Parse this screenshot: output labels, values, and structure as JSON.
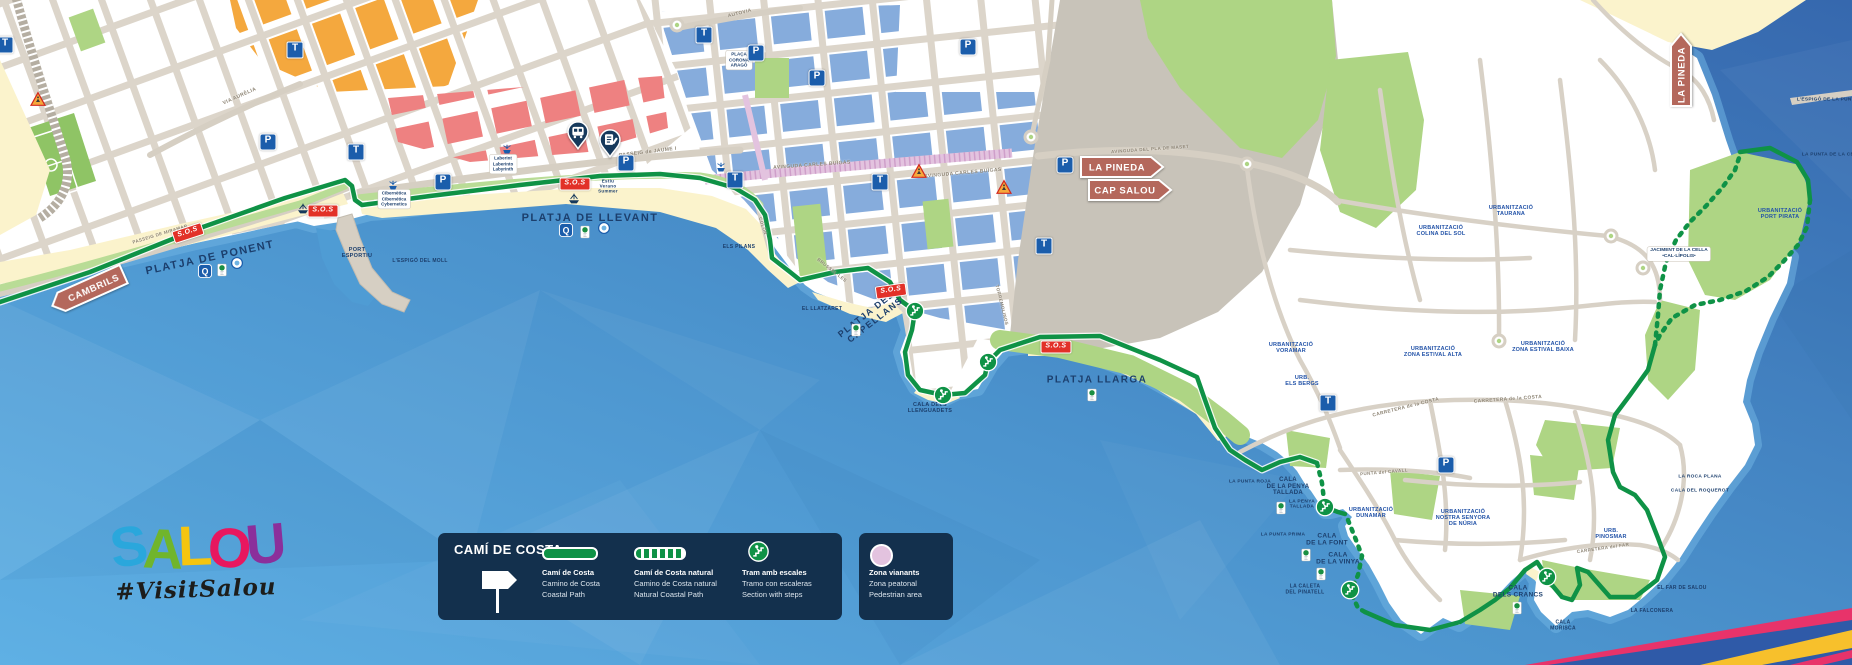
{
  "logo": {
    "letters": [
      {
        "ch": "S",
        "color": "#2aa7dc"
      },
      {
        "ch": "A",
        "color": "#70b52c"
      },
      {
        "ch": "L",
        "color": "#f5c50f"
      },
      {
        "ch": "O",
        "color": "#e8175f"
      },
      {
        "ch": "U",
        "color": "#8b2f9b"
      }
    ],
    "hashtag": "#VisitSalou"
  },
  "legend": {
    "title": "CAMÍ DE COSTA",
    "items": [
      {
        "key": "solid",
        "lines": [
          "Camí de Costa",
          "Camino de Costa",
          "Coastal Path"
        ]
      },
      {
        "key": "dashed",
        "lines": [
          "Camí de Costa natural",
          "Camino de Costa natural",
          "Natural Coastal Path"
        ]
      },
      {
        "key": "stairs",
        "lines": [
          "Tram amb escales",
          "Tramo con escaleras",
          "Section with steps"
        ]
      }
    ],
    "pedestrian": {
      "lines": [
        "Zona vianants",
        "Zona peatonal",
        "Pedestrian area"
      ]
    }
  },
  "signs": [
    {
      "label": "CAMBRILS",
      "dir": "left",
      "x": 88,
      "y": 290,
      "w": 78,
      "rot": -24
    },
    {
      "label": "LA PINEDA",
      "dir": "right",
      "x": 1122,
      "y": 167,
      "w": 82,
      "rot": 0
    },
    {
      "label": "CAP SALOU",
      "dir": "right",
      "x": 1130,
      "y": 190,
      "w": 82,
      "rot": 0
    },
    {
      "label": "LA PINEDA",
      "dir": "up",
      "x": 1681,
      "y": 70,
      "w": 72,
      "rot": 0
    }
  ],
  "map": {
    "icon_glyphs": {
      "parking": "P",
      "tram": "T",
      "sos": "S.O.S"
    },
    "labels": [
      {
        "t": "PLATJA DE PONENT",
        "x": 210,
        "y": 258,
        "r": -12,
        "s": 11,
        "c": "beach"
      },
      {
        "t": "PLATJA DE LLEVANT",
        "x": 590,
        "y": 218,
        "r": 0,
        "s": 11,
        "c": "beach"
      },
      {
        "t": "PLATJA DELS\nCAPELLANS",
        "x": 872,
        "y": 316,
        "r": -38,
        "s": 9,
        "c": "beach"
      },
      {
        "t": "PLATJA LLARGA",
        "x": 1097,
        "y": 380,
        "r": 0,
        "s": 10,
        "c": "beach"
      },
      {
        "t": "PORT\nESPORTIU",
        "x": 357,
        "y": 253,
        "r": 0,
        "s": 5.5,
        "c": "place"
      },
      {
        "t": "L'ESPIGÓ DEL MOLL",
        "x": 420,
        "y": 262,
        "r": 0,
        "s": 5,
        "c": "place"
      },
      {
        "t": "ELS PILANS",
        "x": 739,
        "y": 248,
        "r": 0,
        "s": 5,
        "c": "place"
      },
      {
        "t": "EL LLATZARET",
        "x": 822,
        "y": 310,
        "r": 0,
        "s": 5,
        "c": "place"
      },
      {
        "t": "CALA DELS\nLLENGUADETS",
        "x": 930,
        "y": 408,
        "r": 0,
        "s": 5.5,
        "c": "place"
      },
      {
        "t": "CALA\nDE LA PENYA\nTALLADA",
        "x": 1288,
        "y": 487,
        "r": 0,
        "s": 6,
        "c": "place"
      },
      {
        "t": "LA PENYA\nTALLADA",
        "x": 1302,
        "y": 505,
        "r": 0,
        "s": 4.8,
        "c": "place"
      },
      {
        "t": "LA PUNTA PRIMA",
        "x": 1283,
        "y": 535,
        "r": 0,
        "s": 4.8,
        "c": "place"
      },
      {
        "t": "LA PUNTA ROJA",
        "x": 1250,
        "y": 482,
        "r": 0,
        "s": 4.8,
        "c": "place"
      },
      {
        "t": "CALA\nDE LA FONT",
        "x": 1327,
        "y": 540,
        "r": 0,
        "s": 6.5,
        "c": "place"
      },
      {
        "t": "CALA\nDE LA VINYA",
        "x": 1338,
        "y": 559,
        "r": 0,
        "s": 6.5,
        "c": "place"
      },
      {
        "t": "LA CALETA\nDEL PINATELL",
        "x": 1305,
        "y": 590,
        "r": 0,
        "s": 5,
        "c": "place"
      },
      {
        "t": "CALA\nDELS CRANCS",
        "x": 1518,
        "y": 592,
        "r": 0,
        "s": 6.5,
        "c": "place"
      },
      {
        "t": "CALA\nMORISCA",
        "x": 1563,
        "y": 626,
        "r": 0,
        "s": 5,
        "c": "place"
      },
      {
        "t": "EL FAR DE SALOU",
        "x": 1682,
        "y": 589,
        "r": 0,
        "s": 5,
        "c": "place"
      },
      {
        "t": "LA FALCONERA",
        "x": 1652,
        "y": 612,
        "r": 0,
        "s": 5,
        "c": "place"
      },
      {
        "t": "LA ROCA PLANA",
        "x": 1700,
        "y": 477,
        "r": 0,
        "s": 4.8,
        "c": "place"
      },
      {
        "t": "CALA DEL ROQUEROT",
        "x": 1700,
        "y": 491,
        "r": 0,
        "s": 4.8,
        "c": "place"
      },
      {
        "t": "L'ESPIGÓ DE LA PUNTA P",
        "x": 1830,
        "y": 100,
        "r": 0,
        "s": 4.8,
        "c": "place"
      },
      {
        "t": "LA PUNTA DE LA CELLA",
        "x": 1833,
        "y": 155,
        "r": 0,
        "s": 4.8,
        "c": "place"
      },
      {
        "t": "URBANITZACIÓ\nVORAMAR",
        "x": 1291,
        "y": 348,
        "r": 0,
        "s": 5.5,
        "c": "urb"
      },
      {
        "t": "URB.\nELS BERGS",
        "x": 1302,
        "y": 381,
        "r": 0,
        "s": 5.5,
        "c": "urb"
      },
      {
        "t": "URBANITZACIÓ\nZONA ESTIVAL ALTA",
        "x": 1433,
        "y": 352,
        "r": 0,
        "s": 5.5,
        "c": "urb"
      },
      {
        "t": "URBANITZACIÓ\nZONA ESTIVAL BAIXA",
        "x": 1543,
        "y": 347,
        "r": 0,
        "s": 5.5,
        "c": "urb"
      },
      {
        "t": "URBANITZACIÓ\nTAURANA",
        "x": 1511,
        "y": 211,
        "r": 0,
        "s": 5.5,
        "c": "urb"
      },
      {
        "t": "URBANITZACIÓ\nCOLINA DEL SOL",
        "x": 1441,
        "y": 231,
        "r": 0,
        "s": 5.5,
        "c": "urb"
      },
      {
        "t": "URBANITZACIÓ\nPORT PIRATA",
        "x": 1780,
        "y": 214,
        "r": 0,
        "s": 5.5,
        "c": "urb"
      },
      {
        "t": "URBANITZACIÓ\nDUNAMAR",
        "x": 1371,
        "y": 513,
        "r": 0,
        "s": 5.5,
        "c": "urb"
      },
      {
        "t": "URBANITZACIÓ\nNOSTRA SENYORA\nDE NÚRIA",
        "x": 1463,
        "y": 518,
        "r": 0,
        "s": 5.5,
        "c": "urb"
      },
      {
        "t": "URB.\nPINOSMAR",
        "x": 1611,
        "y": 534,
        "r": 0,
        "s": 5.5,
        "c": "urb"
      },
      {
        "t": "JACIMENT DE LA CELLA\n•CAL·LÍPOLIS•",
        "x": 1679,
        "y": 254,
        "r": 0,
        "s": 4.8,
        "c": "boxed"
      },
      {
        "t": "PLAÇA\nCORONA\nARAGÓ",
        "x": 739,
        "y": 60,
        "r": 0,
        "s": 4.5,
        "c": "boxed"
      },
      {
        "t": "Laberint\nLaberinto\nLabyrinth",
        "x": 503,
        "y": 164,
        "r": 0,
        "s": 4.5,
        "c": "boxed"
      },
      {
        "t": "Cibernètica\nCibernética\nCybernetics",
        "x": 394,
        "y": 199,
        "r": 0,
        "s": 4.5,
        "c": "boxed"
      },
      {
        "t": "Estiu\nVerano\nSummer",
        "x": 608,
        "y": 186,
        "r": 0,
        "s": 4.5,
        "c": "place"
      },
      {
        "t": "PASSEIG de JAUME I",
        "x": 648,
        "y": 153,
        "r": -7,
        "s": 5,
        "c": "street"
      },
      {
        "t": "AVINGUDA CARLES BUÏGAS",
        "x": 963,
        "y": 174,
        "r": -5,
        "s": 5,
        "c": "street"
      },
      {
        "t": "AVINGUDA CARLES BUÏGAS",
        "x": 812,
        "y": 166,
        "r": -4,
        "s": 5,
        "c": "street"
      },
      {
        "t": "AVINGUDA DEL PLA DE MASET",
        "x": 1150,
        "y": 149,
        "r": -4,
        "s": 4.5,
        "c": "street"
      },
      {
        "t": "CARRETERA de la COSTA",
        "x": 1406,
        "y": 408,
        "r": -14,
        "s": 4.8,
        "c": "street"
      },
      {
        "t": "CARRETERA de la COSTA",
        "x": 1508,
        "y": 400,
        "r": -4,
        "s": 4.8,
        "c": "street"
      },
      {
        "t": "VIA AURÈLIA",
        "x": 240,
        "y": 97,
        "r": -24,
        "s": 5,
        "c": "street"
      },
      {
        "t": "CARRETERA del FAR",
        "x": 1603,
        "y": 548,
        "r": -8,
        "s": 4.5,
        "c": "street"
      },
      {
        "t": "PUNTA del CAVALL",
        "x": 1384,
        "y": 472,
        "r": -5,
        "s": 4.5,
        "c": "street"
      },
      {
        "t": "AUTOVIA",
        "x": 740,
        "y": 14,
        "r": -14,
        "s": 4.8,
        "c": "street"
      },
      {
        "t": "PASSEIG DE MIRAMAR",
        "x": 160,
        "y": 234,
        "r": -17,
        "s": 4.5,
        "c": "street"
      },
      {
        "t": "COLÓN",
        "x": 763,
        "y": 226,
        "r": 72,
        "s": 4.5,
        "c": "street"
      },
      {
        "t": "BRUSSEL·LES",
        "x": 832,
        "y": 270,
        "r": 38,
        "s": 4.5,
        "c": "street"
      },
      {
        "t": "TORREMOLINOS",
        "x": 1002,
        "y": 305,
        "r": 76,
        "s": 4.5,
        "c": "street"
      }
    ],
    "icons": [
      {
        "k": "parking",
        "x": 268,
        "y": 142
      },
      {
        "k": "parking",
        "x": 443,
        "y": 182
      },
      {
        "k": "parking",
        "x": 626,
        "y": 163
      },
      {
        "k": "parking",
        "x": 756,
        "y": 53
      },
      {
        "k": "parking",
        "x": 817,
        "y": 78
      },
      {
        "k": "parking",
        "x": 968,
        "y": 47
      },
      {
        "k": "parking",
        "x": 1065,
        "y": 165
      },
      {
        "k": "parking",
        "x": 1446,
        "y": 465
      },
      {
        "k": "tram",
        "x": 5,
        "y": 45
      },
      {
        "k": "tram",
        "x": 295,
        "y": 50
      },
      {
        "k": "tram",
        "x": 356,
        "y": 152
      },
      {
        "k": "tram",
        "x": 704,
        "y": 35
      },
      {
        "k": "tram",
        "x": 735,
        "y": 180
      },
      {
        "k": "tram",
        "x": 880,
        "y": 182
      },
      {
        "k": "tram",
        "x": 1044,
        "y": 246
      },
      {
        "k": "tram",
        "x": 1328,
        "y": 403
      },
      {
        "k": "sos",
        "x": 188,
        "y": 233,
        "r": -18
      },
      {
        "k": "sos",
        "x": 323,
        "y": 211
      },
      {
        "k": "sos",
        "x": 575,
        "y": 184
      },
      {
        "k": "sos",
        "x": 891,
        "y": 291,
        "r": -8
      },
      {
        "k": "sos",
        "x": 1056,
        "y": 347
      },
      {
        "k": "stairs",
        "x": 915,
        "y": 311
      },
      {
        "k": "stairs",
        "x": 943,
        "y": 395
      },
      {
        "k": "stairs",
        "x": 988,
        "y": 362
      },
      {
        "k": "stairs",
        "x": 1325,
        "y": 507
      },
      {
        "k": "stairs",
        "x": 1350,
        "y": 590
      },
      {
        "k": "stairs",
        "x": 1547,
        "y": 577
      },
      {
        "k": "warn",
        "x": 38,
        "y": 99
      },
      {
        "k": "warn",
        "x": 919,
        "y": 171
      },
      {
        "k": "warn",
        "x": 1004,
        "y": 187
      },
      {
        "k": "pinbus",
        "x": 578,
        "y": 135
      },
      {
        "k": "pininfo",
        "x": 610,
        "y": 143
      },
      {
        "k": "fountain",
        "x": 393,
        "y": 186
      },
      {
        "k": "fountain",
        "x": 721,
        "y": 168
      },
      {
        "k": "fountain",
        "x": 507,
        "y": 150
      },
      {
        "k": "ship",
        "x": 303,
        "y": 208
      },
      {
        "k": "ship",
        "x": 574,
        "y": 198
      },
      {
        "k": "q",
        "x": 205,
        "y": 271
      },
      {
        "k": "q",
        "x": 566,
        "y": 230
      },
      {
        "k": "flag",
        "x": 222,
        "y": 270
      },
      {
        "k": "flag",
        "x": 585,
        "y": 232
      },
      {
        "k": "flag",
        "x": 856,
        "y": 330
      },
      {
        "k": "flag",
        "x": 1092,
        "y": 395
      },
      {
        "k": "flag",
        "x": 1281,
        "y": 508
      },
      {
        "k": "flag",
        "x": 1306,
        "y": 555
      },
      {
        "k": "flag",
        "x": 1321,
        "y": 574
      },
      {
        "k": "flag",
        "x": 1517,
        "y": 608
      },
      {
        "k": "iso",
        "x": 237,
        "y": 263
      },
      {
        "k": "iso",
        "x": 604,
        "y": 228
      }
    ]
  },
  "colors": {
    "sea_deep": "#3a70b4",
    "sea_light": "#5fb0e4",
    "path_green": "#0f9246",
    "sign_brown": "#b4685c",
    "navy": "#13304d",
    "label_navy": "#1c3f6d",
    "urb_blue": "#2353a8",
    "street_label": "#8d8474",
    "beach_sand": "#fbf3cc",
    "block_orange": "#f4a83e",
    "block_red": "#ee8181",
    "block_blue": "#86acdc",
    "pedestrian_pink": "#e3c3df",
    "icon_blue": "#1b5dab",
    "sos_red": "#e23128"
  }
}
